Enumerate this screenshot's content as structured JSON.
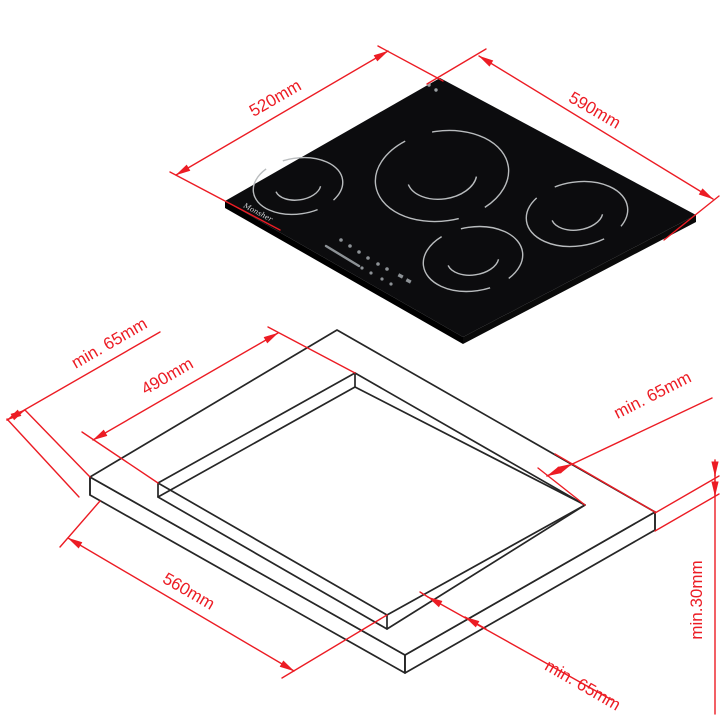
{
  "cooktop": {
    "width_label": "520mm",
    "depth_label": "590mm",
    "brand": "Monsher",
    "burner_count": 4
  },
  "cutout": {
    "depth_label": "490mm",
    "width_label": "560mm",
    "clearance_back": "min. 65mm",
    "clearance_right": "min. 65mm",
    "clearance_front": "min. 65mm",
    "thickness_label": "min.30mm"
  },
  "colors": {
    "dimension_red": "#ec1c24",
    "drawing_black": "#262626",
    "cooktop_surface": "#0c0c0e",
    "burner_ring": "#b9bcbe"
  }
}
